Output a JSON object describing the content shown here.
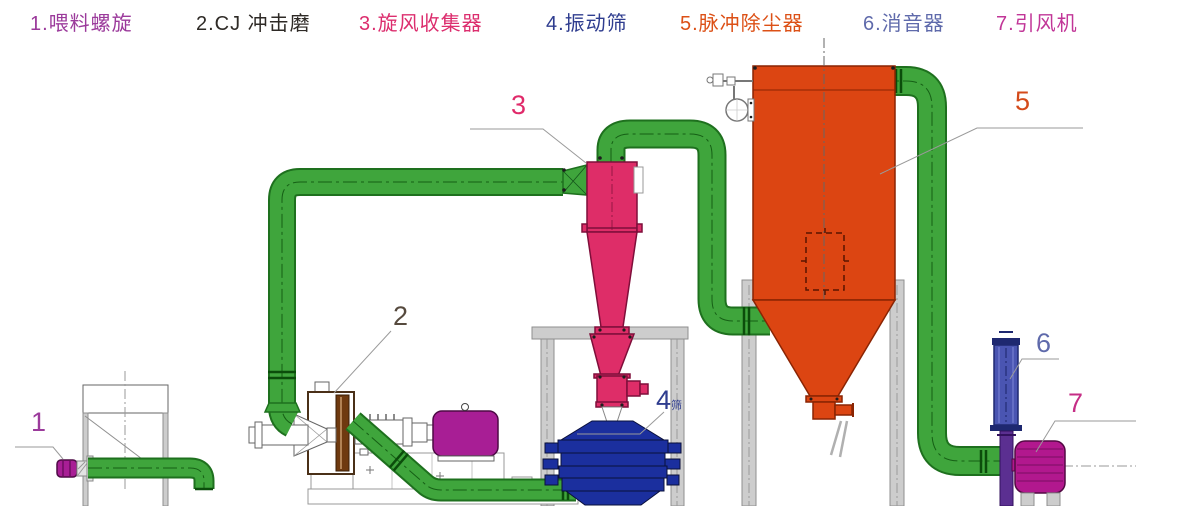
{
  "legend": {
    "items": [
      {
        "label": "1.喂料螺旋",
        "color": "#9B3A9B"
      },
      {
        "label": "2.CJ 冲击磨",
        "color": "#2E2A26"
      },
      {
        "label": "3.旋风收集器",
        "color": "#DC2E6E"
      },
      {
        "label": "4.振动筛",
        "color": "#2F3D8F"
      },
      {
        "label": "5.脉冲除尘器",
        "color": "#DC5016"
      },
      {
        "label": "6.消音器",
        "color": "#5F6AAB"
      },
      {
        "label": "7.引风机",
        "color": "#C13597"
      }
    ]
  },
  "callouts": [
    {
      "number": "1",
      "color": "#9B3A9B"
    },
    {
      "number": "2",
      "color": "#564A3E"
    },
    {
      "number": "3",
      "color": "#E02A6A"
    },
    {
      "number": "4",
      "color": "#2F3D8F",
      "suffix": "筛"
    },
    {
      "number": "5",
      "color": "#D44A1A"
    },
    {
      "number": "6",
      "color": "#5F6AAB"
    },
    {
      "number": "7",
      "color": "#C52E86"
    }
  ],
  "theme": {
    "bg": "#FFFFFF",
    "pipe-green": "#3FA53C",
    "pipe-green-dark": "#1E701E",
    "pipe-center": "#0B4D0B",
    "cyclone-pink": "#DE2D68",
    "cyclone-pink-dark": "#7F0E3A",
    "collector-orange": "#DC4512",
    "collector-orange-dark": "#8A2403",
    "screen-navy": "#1B2F9E",
    "screen-navy-dark": "#0A103B",
    "muffler-blue": "#4A55B2",
    "muffler-blue-dark": "#1E2870",
    "duct-purple": "#5B2F91",
    "fan-magenta": "#B2188E",
    "motor-magenta": "#A81E95",
    "motor-magenta-dark": "#4D0A45",
    "structure-gray": "#CDCDCD",
    "structure-gray-dark": "#8F8F8F",
    "leader-gray": "#9A9A9A"
  }
}
